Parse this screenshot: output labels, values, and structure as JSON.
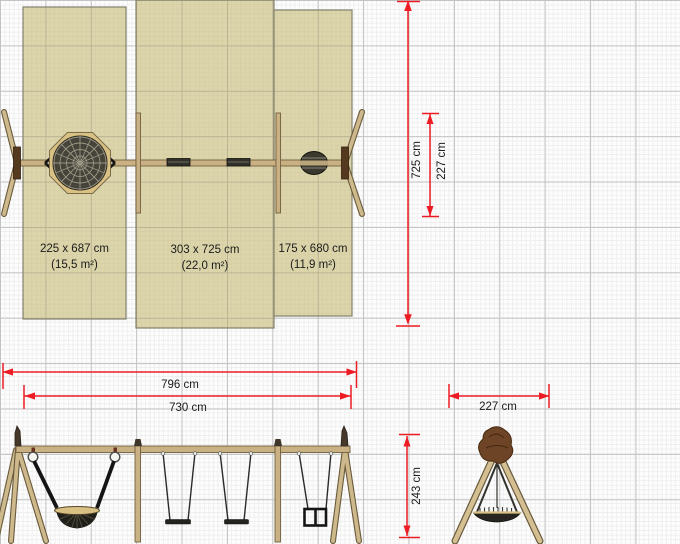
{
  "plan": {
    "zones": [
      {
        "size": "225 x 687 cm",
        "area": "(15,5 m²)"
      },
      {
        "size": "303 x 725 cm",
        "area": "(22,0 m²)"
      },
      {
        "size": "175 x 680 cm",
        "area": "(11,9 m²)"
      }
    ]
  },
  "dims": {
    "zone_height": "725 cm",
    "frame_depth_plan": "227 cm",
    "overall_length": "796 cm",
    "beam_length": "730 cm",
    "frame_depth_side": "227 cm",
    "frame_height": "243 cm"
  },
  "colors": {
    "dimension_red": "#ed1c24",
    "zone_fill": "#dcd5ab",
    "wood_tan": "#c9b184",
    "grid_major": "#c3c3c3",
    "grid_minor": "#eeeeee",
    "cap_brown": "#6d4526"
  }
}
